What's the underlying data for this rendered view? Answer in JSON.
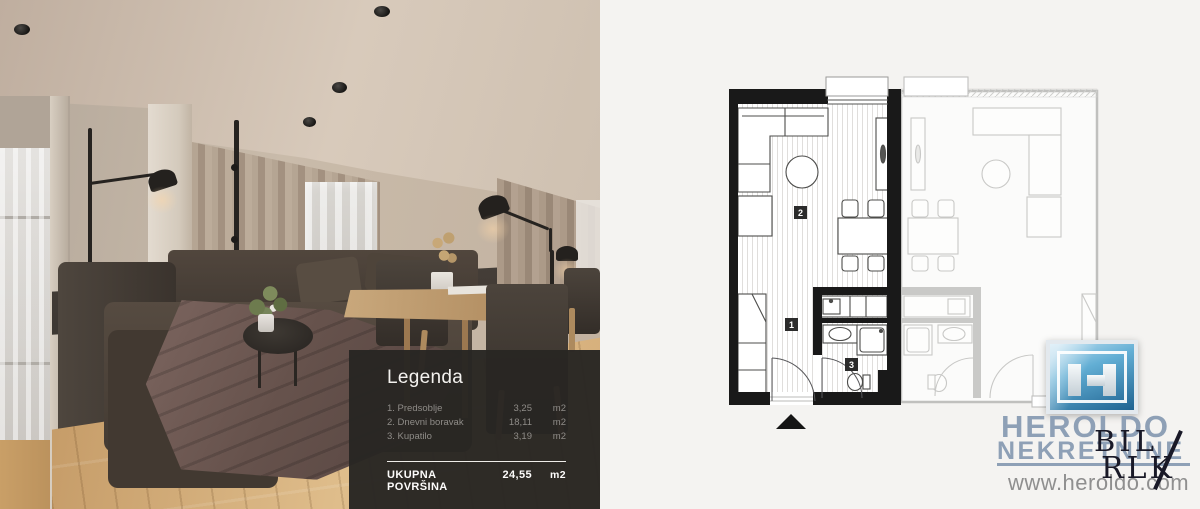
{
  "legend": {
    "title": "Legenda",
    "items": [
      {
        "name": "1. Predsoblje",
        "value": "3,25",
        "unit": "m2"
      },
      {
        "name": "2. Dnevni boravak",
        "value": "18,11",
        "unit": "m2"
      },
      {
        "name": "3. Kupatilo",
        "value": "3,19",
        "unit": "m2"
      }
    ],
    "total_label": "UKUPNA POVRŠINA",
    "total_value": "24,55",
    "total_unit": "m2",
    "panel_bg": "#282623"
  },
  "floorplan": {
    "room_labels": [
      "2",
      "1",
      "3"
    ],
    "entrance_marker": "triangle-up",
    "wall_color": "#191919",
    "adjacent_unit_color": "#c8c8c6",
    "hatch_color": "#dddbd8"
  },
  "branding": {
    "company": "HEROLDO",
    "subtitle": "NEKRETNINE",
    "website": "www.heroldo.com",
    "monogram_top": "BIL",
    "monogram_bottom": "RLK",
    "brand_color": "#8ea0b6",
    "icon_blue": "#2e7cab",
    "url_color": "#8f8f8f"
  },
  "photo": {
    "palette": {
      "wall": "#c4b4a4",
      "ceiling": "#d2c3b4",
      "floor_wood": "#d9b27e",
      "sofa": "#4a423b",
      "blanket": "#6f5a54",
      "curtain": "#a6947f"
    }
  }
}
